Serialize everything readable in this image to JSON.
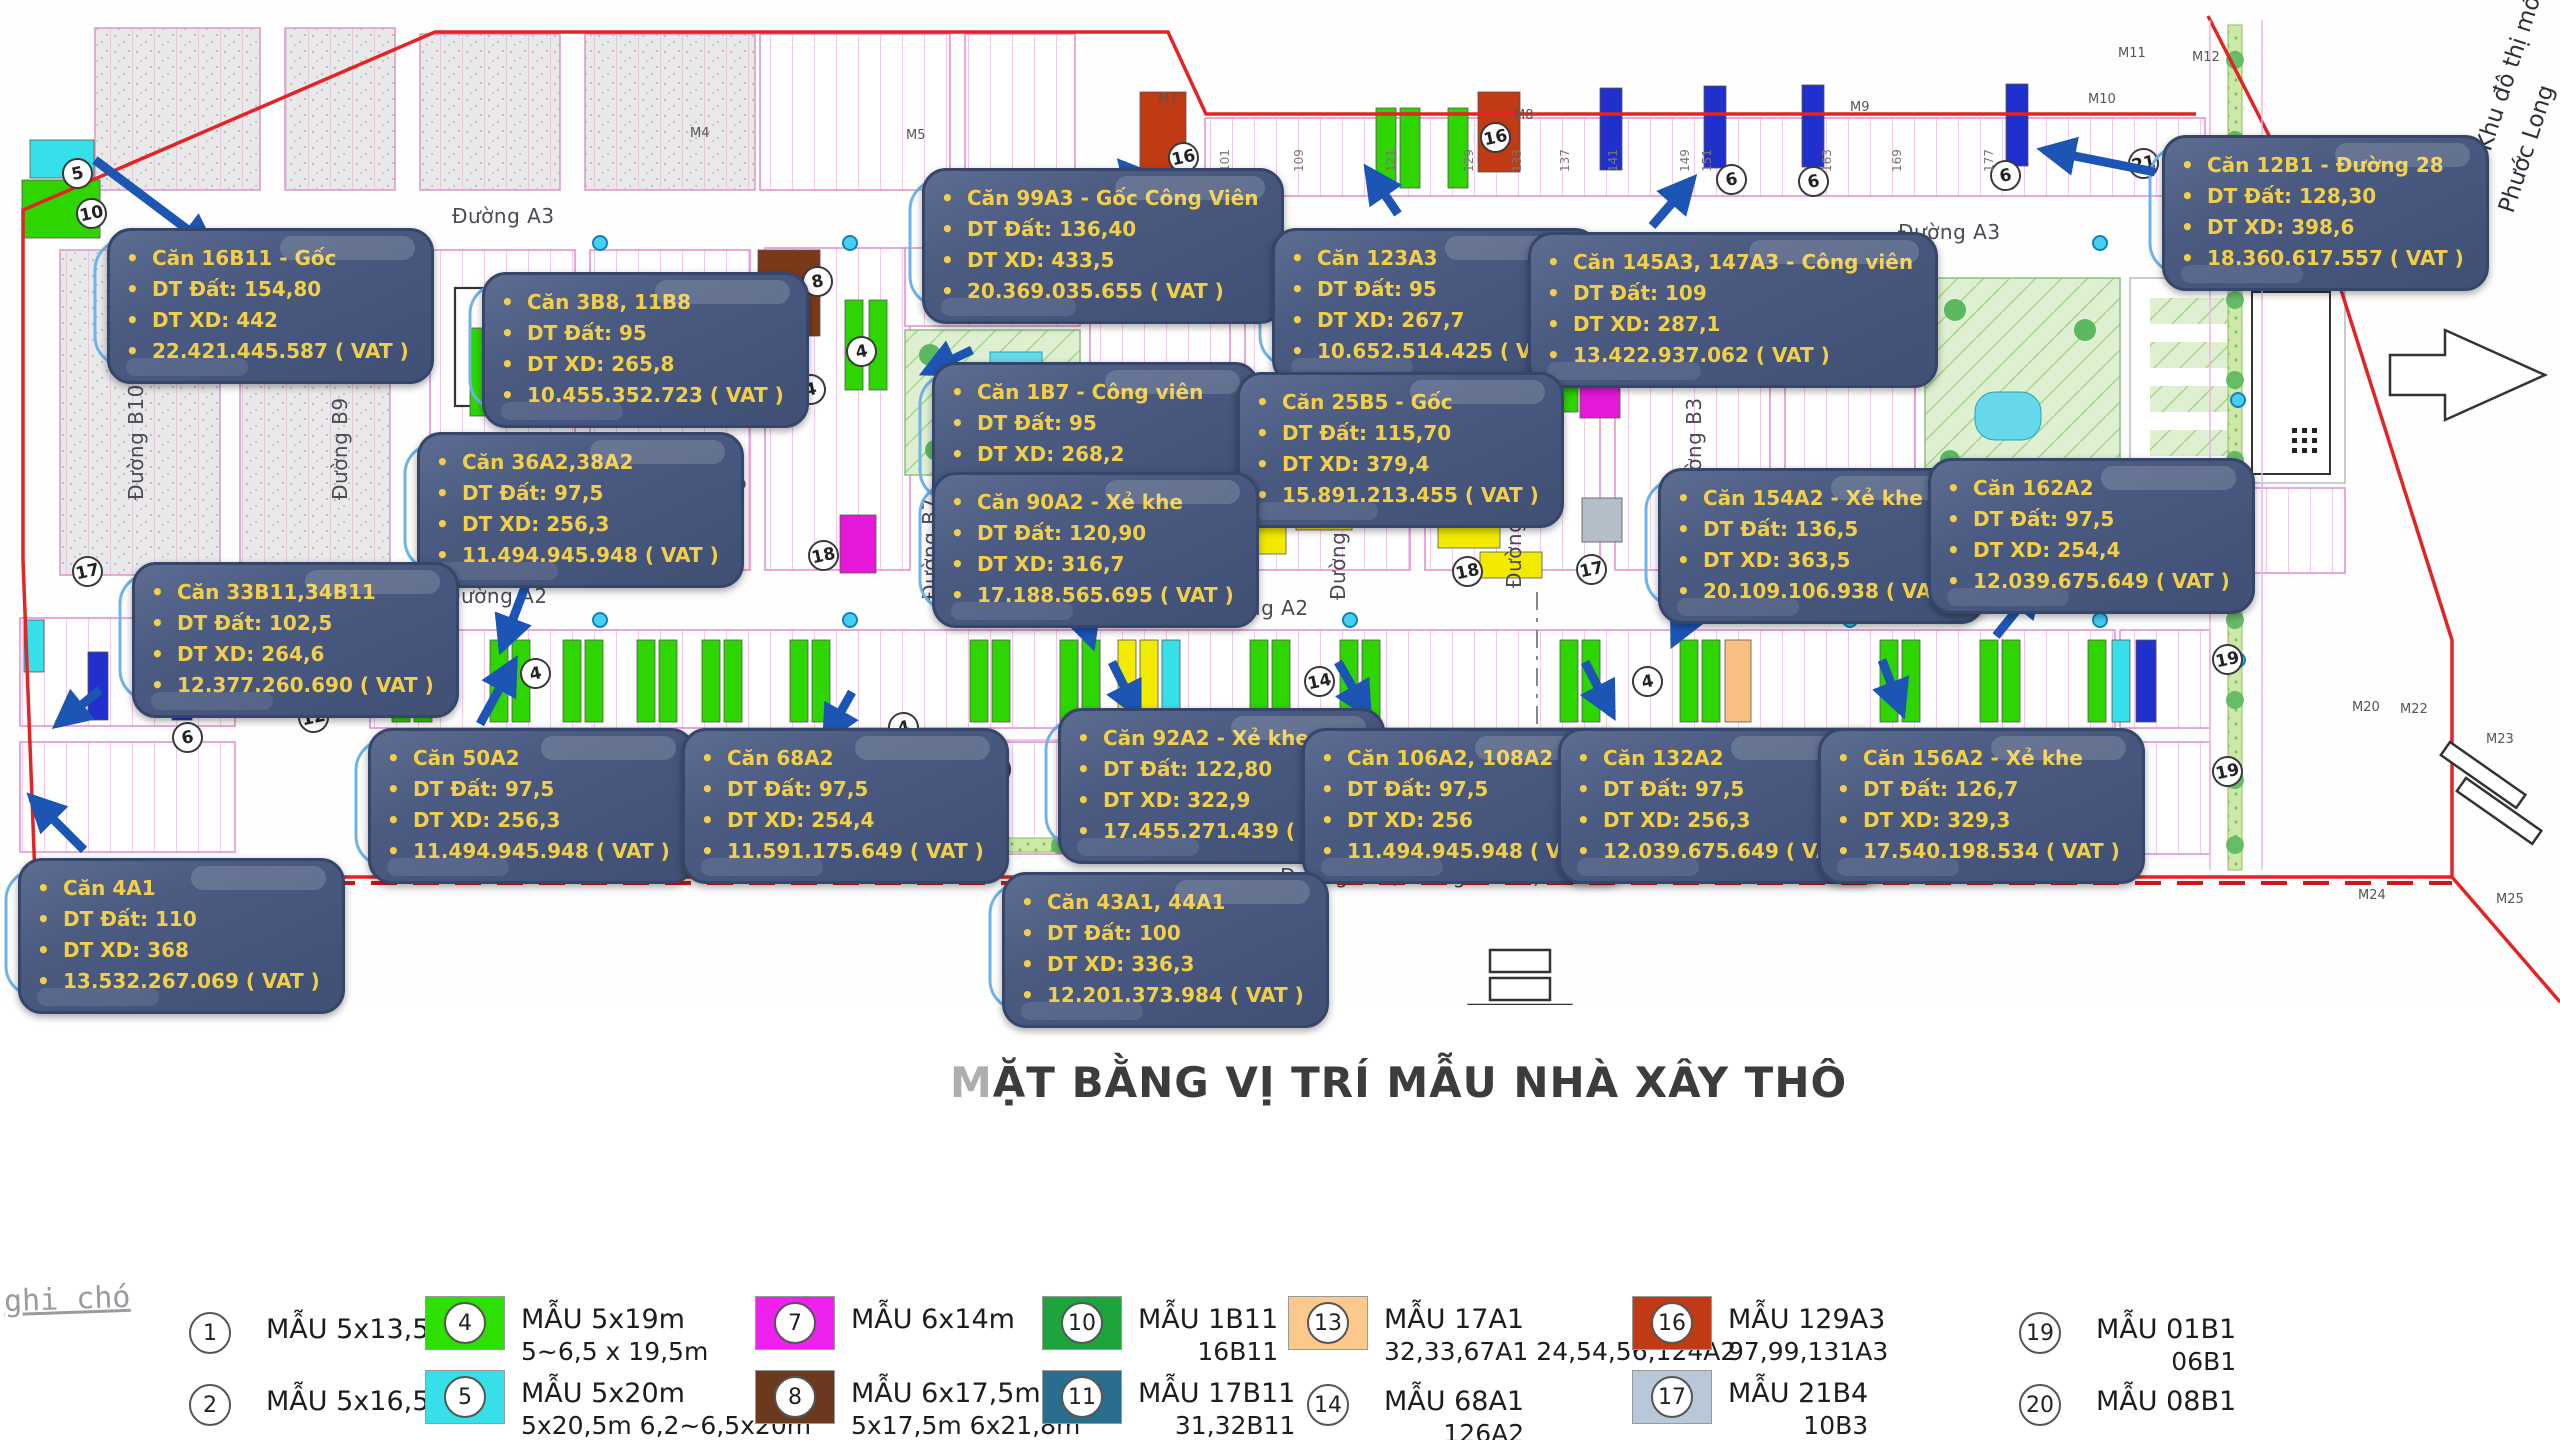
{
  "title": {
    "lead": "M",
    "rest": "ẶT BẰNG VỊ TRÍ MẪU NHÀ XÂY THÔ"
  },
  "note": "ghi chó",
  "project_side_text": {
    "line1": "Dự án Khu đô thị mới",
    "line2": "Phước Long"
  },
  "colors": {
    "callout_bg": "#4a5a80",
    "callout_text": "#f2cf4a",
    "arrow_blue": "#1d55b5",
    "leader_blue": "#6fb3e8",
    "boundary_red": "#e02020",
    "lot_line_pink": "#f0b4e4",
    "green_lot": "#2ed500",
    "cyan_lot": "#35e0e8",
    "blue_lot": "#2030cc",
    "magenta_lot": "#e818d8",
    "yellow_lot": "#f2ea00",
    "brown_lot": "#7a3a1a",
    "dark_red_lot": "#c03a14",
    "orange_lot": "#f8c080",
    "teal_lot": "#2a6e8e",
    "gray_lot": "#b4bec8",
    "dark_green_lot": "#1ea43c"
  },
  "callouts": [
    {
      "name": "Căn 16B11 - Gốc",
      "dt_dat": "DT Đất: 154,80",
      "dt_xd": "DT XD: 442",
      "price": "22.421.445.587 ( VAT )",
      "x": 107,
      "y": 228,
      "ax1": 95,
      "ay1": 160,
      "ax2": 212,
      "ay2": 248
    },
    {
      "name": "Căn 3B8, 11B8",
      "dt_dat": "DT Đất: 95",
      "dt_xd": "DT XD: 265,8",
      "price": "10.455.352.723 ( VAT )",
      "x": 482,
      "y": 272,
      "ax1": 800,
      "ay1": 384,
      "ax2": 714,
      "ay2": 352
    },
    {
      "name": "Căn 99A3 - Gốc Công Viên",
      "dt_dat": "DT Đất: 136,40",
      "dt_xd": "DT XD: 433,5",
      "price": "20.369.035.655 ( VAT )",
      "x": 922,
      "y": 168,
      "ax1": 1165,
      "ay1": 212,
      "ax2": 1122,
      "ay2": 164
    },
    {
      "name": "Căn 123A3",
      "dt_dat": "DT Đất: 95",
      "dt_xd": "DT XD: 267,7",
      "price": "10.652.514.425 ( VAT )",
      "x": 1272,
      "y": 228,
      "ax1": 1398,
      "ay1": 214,
      "ax2": 1368,
      "ay2": 170
    },
    {
      "name": "Căn 145A3, 147A3 - Công viên",
      "dt_dat": "DT Đất: 109",
      "dt_xd": "DT XD: 287,1",
      "price": "13.422.937.062 ( VAT )",
      "x": 1528,
      "y": 232,
      "ax1": 1652,
      "ay1": 226,
      "ax2": 1692,
      "ay2": 180
    },
    {
      "name": "Căn 12B1 - Đường 28",
      "dt_dat": "DT Đất: 128,30",
      "dt_xd": "DT XD: 398,6",
      "price": "18.360.617.557 ( VAT )",
      "x": 2162,
      "y": 135,
      "ax1": 2155,
      "ay1": 172,
      "ax2": 2044,
      "ay2": 150
    },
    {
      "name": "Căn 1B7 - Công viên",
      "dt_dat": "DT Đất: 95",
      "dt_xd": "DT XD: 268,2",
      "price": "11.749.571.142 ( VAT )",
      "x": 932,
      "y": 362,
      "ax1": 972,
      "ay1": 350,
      "ax2": 926,
      "ay2": 372
    },
    {
      "name": "Căn 25B5 - Gốc",
      "dt_dat": "DT Đất: 115,70",
      "dt_xd": "DT XD: 379,4",
      "price": "15.891.213.455 ( VAT )",
      "x": 1237,
      "y": 372,
      "ax1": 1442,
      "ay1": 488,
      "ax2": 1478,
      "ay2": 520
    },
    {
      "name": "Căn 36A2,38A2",
      "dt_dat": "DT Đất: 97,5",
      "dt_xd": "DT XD: 256,3",
      "price": "11.494.945.948 ( VAT )",
      "x": 417,
      "y": 432,
      "ax1": 530,
      "ay1": 574,
      "ax2": 502,
      "ay2": 648
    },
    {
      "name": "Căn 90A2 - Xẻ khe",
      "dt_dat": "DT Đất: 120,90",
      "dt_xd": "DT XD: 316,7",
      "price": "17.188.565.695 ( VAT )",
      "x": 932,
      "y": 472,
      "ax1": 1070,
      "ay1": 578,
      "ax2": 1092,
      "ay2": 644
    },
    {
      "name": "Căn 154A2 - Xẻ khe",
      "dt_dat": "DT Đất: 136,5",
      "dt_xd": "DT XD: 363,5",
      "price": "20.109.106.938 ( VAT )",
      "x": 1658,
      "y": 468,
      "ax1": 1702,
      "ay1": 584,
      "ax2": 1674,
      "ay2": 642
    },
    {
      "name": "Căn 162A2",
      "dt_dat": "DT Đất: 97,5",
      "dt_xd": "DT XD: 254,4",
      "price": "12.039.675.649 ( VAT )",
      "x": 1928,
      "y": 458,
      "ax1": 1996,
      "ay1": 636,
      "ax2": 2038,
      "ay2": 584
    },
    {
      "name": "Căn 33B11,34B11",
      "dt_dat": "DT Đất: 102,5",
      "dt_xd": "DT XD: 264,6",
      "price": "12.377.260.690 ( VAT )",
      "x": 132,
      "y": 562,
      "ax1": 100,
      "ay1": 690,
      "ax2": 58,
      "ay2": 724
    },
    {
      "name": "Căn 50A2",
      "dt_dat": "DT Đất: 97,5",
      "dt_xd": "DT XD: 256,3",
      "price": "11.494.945.948 ( VAT )",
      "x": 368,
      "y": 728,
      "ax1": 480,
      "ay1": 724,
      "ax2": 514,
      "ay2": 662
    },
    {
      "name": "Căn 68A2",
      "dt_dat": "DT Đất: 97,5",
      "dt_xd": "DT XD: 254,4",
      "price": "11.591.175.649 ( VAT )",
      "x": 682,
      "y": 728,
      "ax1": 852,
      "ay1": 692,
      "ax2": 826,
      "ay2": 738
    },
    {
      "name": "Căn 92A2 - Xẻ khe",
      "dt_dat": "DT Đất: 122,80",
      "dt_xd": "DT XD: 322,9",
      "price": "17.455.271.439 ( VAT )",
      "x": 1058,
      "y": 708,
      "ax1": 1112,
      "ay1": 662,
      "ax2": 1138,
      "ay2": 714
    },
    {
      "name": "Căn 106A2, 108A2",
      "dt_dat": "DT Đất: 97,5",
      "dt_xd": "DT XD: 256",
      "price": "11.494.945.948 ( VAT )",
      "x": 1302,
      "y": 728,
      "ax1": 1338,
      "ay1": 662,
      "ax2": 1368,
      "ay2": 714
    },
    {
      "name": "Căn 132A2",
      "dt_dat": "DT Đất: 97,5",
      "dt_xd": "DT XD: 256,3",
      "price": "12.039.675.649 ( VAT )",
      "x": 1558,
      "y": 728,
      "ax1": 1585,
      "ay1": 662,
      "ax2": 1612,
      "ay2": 714
    },
    {
      "name": "Căn 156A2 - Xẻ khe",
      "dt_dat": "DT Đất: 126,7",
      "dt_xd": "DT XD: 329,3",
      "price": "17.540.198.534 ( VAT )",
      "x": 1818,
      "y": 728,
      "ax1": 1882,
      "ay1": 660,
      "ax2": 1902,
      "ay2": 712
    },
    {
      "name": "Căn 4A1",
      "dt_dat": "DT Đất: 110",
      "dt_xd": "DT XD: 368",
      "price": "13.532.267.069 ( VAT )",
      "x": 18,
      "y": 858,
      "ax1": 84,
      "ay1": 850,
      "ax2": 32,
      "ay2": 798
    },
    {
      "name": "Căn 43A1, 44A1",
      "dt_dat": "DT Đất: 100",
      "dt_xd": "DT XD: 336,3",
      "price": "12.201.373.984 ( VAT )",
      "x": 1002,
      "y": 872,
      "ax1": 972,
      "ay1": 820,
      "ax2": 988,
      "ay2": 868
    }
  ],
  "legend": [
    {
      "num": "1",
      "label": "MẪU 5x13,5m",
      "sub": "",
      "color": null
    },
    {
      "num": "4",
      "label": "MẪU 5x19m",
      "sub": "5~6,5 x 19,5m",
      "color": "#2ee000"
    },
    {
      "num": "7",
      "label": "MẪU 6x14m",
      "sub": "",
      "color": "#ee22ee"
    },
    {
      "num": "10",
      "label": "MẪU 1B11",
      "sub": "16B11",
      "color": "#1ea43c"
    },
    {
      "num": "13",
      "label": "MẪU 17A1",
      "sub": "32,33,67A1 24,54,56,124A2",
      "color": "#fbc98c"
    },
    {
      "num": "16",
      "label": "MẪU 129A3",
      "sub": "97,99,131A3",
      "color": "#c03a14"
    },
    {
      "num": "19",
      "label": "MẪU 01B1",
      "sub": "06B1",
      "color": null
    },
    {
      "num": "2",
      "label": "MẪU 5x16,5m",
      "sub": "",
      "color": null
    },
    {
      "num": "5",
      "label": "MẪU 5x20m",
      "sub": "5x20,5m 6,2~6,5x20m",
      "color": "#35e0e8"
    },
    {
      "num": "8",
      "label": "MẪU 6x17,5m",
      "sub": "5x17,5m 6x21,8m",
      "color": "#6b3a1e"
    },
    {
      "num": "11",
      "label": "MẪU 17B11",
      "sub": "31,32B11",
      "color": "#2a6e8e"
    },
    {
      "num": "14",
      "label": "MẪU 68A1",
      "sub": "126A2",
      "color": null
    },
    {
      "num": "17",
      "label": "MẪU 21B4",
      "sub": "10B3",
      "color": "#b8c8d8"
    },
    {
      "num": "20",
      "label": "MẪU 08B1",
      "sub": "",
      "color": null
    }
  ],
  "map": {
    "roads": [
      [
        "Đường A3",
        452,
        204,
        0
      ],
      [
        "Đường A3",
        1898,
        220,
        0
      ],
      [
        "Đường A2",
        445,
        584,
        0
      ],
      [
        "Đường A2",
        1206,
        596,
        0
      ],
      [
        "Đường A2",
        1942,
        586,
        0
      ],
      [
        "Đường A1 (Đường Số 1A)",
        1280,
        864,
        0
      ],
      [
        "Đường A1 (Đường Số 1A)",
        60,
        864,
        0
      ],
      [
        "Đường B10",
        124,
        500,
        1
      ],
      [
        "Đường B9",
        328,
        500,
        1
      ],
      [
        "Đường B8",
        722,
        545,
        1
      ],
      [
        "Đường B7",
        918,
        600,
        1
      ],
      [
        "Đường B6",
        1096,
        620,
        1
      ],
      [
        "Đường B5",
        1326,
        600,
        1
      ],
      [
        "Đường B4",
        1502,
        588,
        1
      ],
      [
        "Đường B3",
        1682,
        500,
        1
      ]
    ],
    "circles": [
      [
        "5",
        62,
        158
      ],
      [
        "10",
        76,
        198
      ],
      [
        "17",
        72,
        556
      ],
      [
        "12",
        298,
        702
      ],
      [
        "6",
        172,
        722
      ],
      [
        "13",
        382,
        674
      ],
      [
        "4",
        520,
        658
      ],
      [
        "15",
        764,
        296
      ],
      [
        "8",
        802,
        266
      ],
      [
        "4",
        846,
        336
      ],
      [
        "4",
        795,
        374
      ],
      [
        "18",
        808,
        540
      ],
      [
        "5",
        980,
        754
      ],
      [
        "4",
        888,
        712
      ],
      [
        "16",
        1168,
        142
      ],
      [
        "16",
        1480,
        122
      ],
      [
        "7",
        1205,
        504
      ],
      [
        "3",
        1202,
        556
      ],
      [
        "18",
        1452,
        556
      ],
      [
        "17",
        1576,
        554
      ],
      [
        "6",
        1716,
        164
      ],
      [
        "6",
        1798,
        166
      ],
      [
        "6",
        1990,
        160
      ],
      [
        "21",
        2128,
        148
      ],
      [
        "14",
        1304,
        666
      ],
      [
        "4",
        1632,
        666
      ],
      [
        "19",
        2212,
        644
      ],
      [
        "19",
        2212,
        756
      ]
    ],
    "m_markers": [
      [
        "M4",
        690,
        126
      ],
      [
        "M5",
        906,
        128
      ],
      [
        "M7",
        1158,
        92
      ],
      [
        "M8",
        1514,
        108
      ],
      [
        "M9",
        1850,
        100
      ],
      [
        "M10",
        2088,
        92
      ],
      [
        "M11",
        2118,
        46
      ],
      [
        "M12",
        2192,
        50
      ],
      [
        "M20",
        2352,
        700
      ],
      [
        "M22",
        2400,
        702
      ],
      [
        "M23",
        2486,
        732
      ],
      [
        "M24",
        2358,
        888
      ],
      [
        "M25",
        2496,
        892
      ]
    ],
    "lot_numbers": [
      [
        "101",
        1218,
        172
      ],
      [
        "109",
        1292,
        172
      ],
      [
        "121",
        1384,
        172
      ],
      [
        "129",
        1462,
        172
      ],
      [
        "133",
        1510,
        172
      ],
      [
        "137",
        1558,
        172
      ],
      [
        "141",
        1606,
        172
      ],
      [
        "149",
        1678,
        172
      ],
      [
        "151",
        1700,
        172
      ],
      [
        "163",
        1820,
        172
      ],
      [
        "169",
        1890,
        172
      ],
      [
        "177",
        1982,
        172
      ],
      [
        "27",
        592,
        786
      ],
      [
        "28",
        614,
        786
      ],
      [
        "29",
        636,
        786
      ],
      [
        "30",
        658,
        786
      ],
      [
        "57",
        1078,
        790
      ],
      [
        "58",
        1100,
        790
      ],
      [
        "77",
        1612,
        786
      ],
      [
        "78",
        1634,
        786
      ],
      [
        "79",
        1656,
        786
      ],
      [
        "80",
        1678,
        786
      ],
      [
        "89",
        1970,
        786
      ],
      [
        "90",
        1992,
        786
      ]
    ]
  }
}
